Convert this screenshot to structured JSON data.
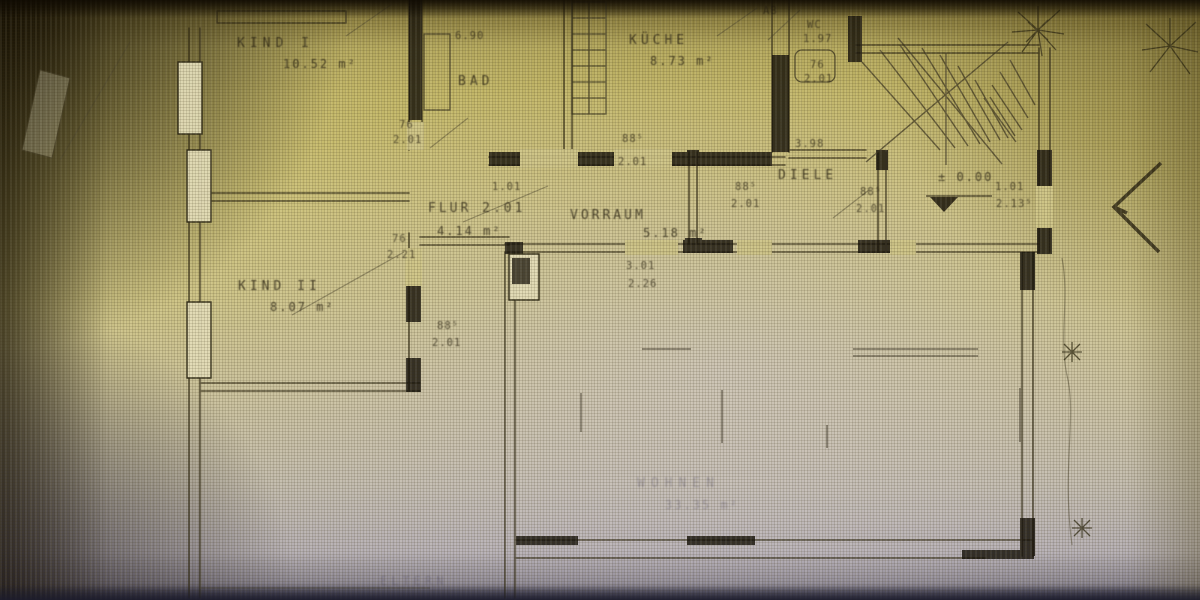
{
  "photo": {
    "description": "photograph of an architectural floor plan (German apartment ground floor), yellow-tinted screen photo",
    "colors": {
      "paper": "#c8bd7a",
      "ink": "#2f2a16",
      "shadow": "#1a140a",
      "cool_cast": "#b9b2c4"
    }
  },
  "rooms": {
    "kind1": {
      "name": "KIND I",
      "area": "10.52 m²"
    },
    "bad": {
      "name": "BAD",
      "area": "6.90"
    },
    "kueche": {
      "name": "KÜCHE",
      "area": "8.73 m²"
    },
    "ab": {
      "name": "AB"
    },
    "wc": {
      "name": "WC",
      "area": "1.97"
    },
    "flur": {
      "name": "FLUR 2.01",
      "area": "4.14 m²"
    },
    "vorraum": {
      "name": "VORRAUM",
      "area": "5.18 m²"
    },
    "diele": {
      "name": "DIELE",
      "area": "3.98"
    },
    "kind2": {
      "name": "KIND II",
      "area": "8.07 m²"
    },
    "wohnen": {
      "name": "WOHNEN",
      "area": "33.35 m²"
    },
    "eltern": {
      "name": "ELTERN"
    }
  },
  "dimensions": {
    "bad_door": {
      "w": "76",
      "h": "2.01"
    },
    "wc_door": {
      "w": "76",
      "h": "2.01"
    },
    "kueche_door": {
      "w": "88⁵",
      "h": "2.01"
    },
    "kind2_door": {
      "w": "76",
      "h": "2.21"
    },
    "kind2_door2": {
      "w": "88⁵",
      "h": "2.01"
    },
    "diele_door1": {
      "w": "88⁵",
      "h": "2.01"
    },
    "diele_door2": {
      "w": "88⁵",
      "h": "2.01"
    },
    "entry_door": {
      "w": "1.01",
      "h": "2.13⁵"
    },
    "wohnen_opening": {
      "w": "3.01",
      "h": "2.26"
    },
    "flur_opening": {
      "w": "1.01"
    }
  },
  "annotations": {
    "level": "± 0.00"
  }
}
